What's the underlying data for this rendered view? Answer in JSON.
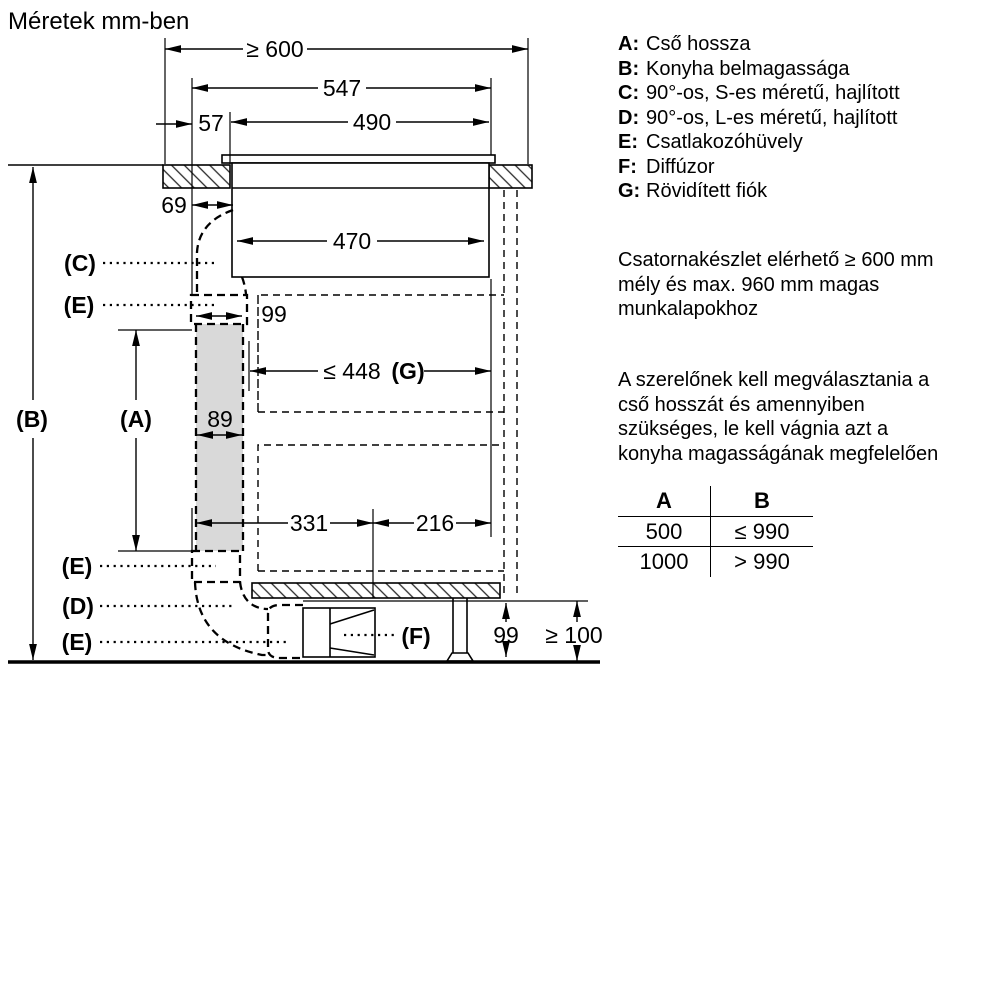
{
  "page": {
    "title": "Méretek mm-ben"
  },
  "diagram": {
    "dimensions": {
      "worktop_depth": "≥ 600",
      "width_547": "547",
      "offset_57": "57",
      "cutout_490": "490",
      "offset_69": "69",
      "body_width_470": "470",
      "sleeve_width_99": "99",
      "drawer_max_prefix": "≤ 448",
      "drawer_max_key": "(G)",
      "duct_width_89": "89",
      "dist_331": "331",
      "dist_216": "216",
      "diffuser_height_99": "99",
      "plinth_height": "≥ 100"
    },
    "callouts": {
      "a": "(A)",
      "b": "(B)",
      "c": "(C)",
      "d": "(D)",
      "e1": "(E)",
      "e2": "(E)",
      "e3": "(E)",
      "f": "(F)"
    }
  },
  "legend": {
    "items": [
      {
        "key": "A:",
        "label": "Cső hossza"
      },
      {
        "key": "B:",
        "label": "Konyha belmagassága"
      },
      {
        "key": "C:",
        "label": "90°-os, S-es méretű, hajlított"
      },
      {
        "key": "D:",
        "label": "90°-os, L-es méretű, hajlított"
      },
      {
        "key": "E:",
        "label": "Csatlakozóhüvely"
      },
      {
        "key": "F:",
        "label": "Diffúzor"
      },
      {
        "key": "G:",
        "label": "Rövidített fiók"
      }
    ]
  },
  "notes": {
    "n1": [
      "Csatornakészlet elérhető ≥ 600 mm",
      "mély és max. 960 mm magas",
      "munkalapokhoz"
    ],
    "n2": [
      "A szerelőnek kell megválasztania a",
      "cső hosszát és amennyiben",
      "szükséges, le kell vágnia azt a",
      "konyha magasságának megfelelően"
    ]
  },
  "table": {
    "headers": [
      "A",
      "B"
    ],
    "rows": [
      [
        "500",
        "≤ 990"
      ],
      [
        "1000",
        "> 990"
      ]
    ]
  },
  "colors": {
    "duct_fill": "#d9d9d9",
    "line": "#000000"
  }
}
